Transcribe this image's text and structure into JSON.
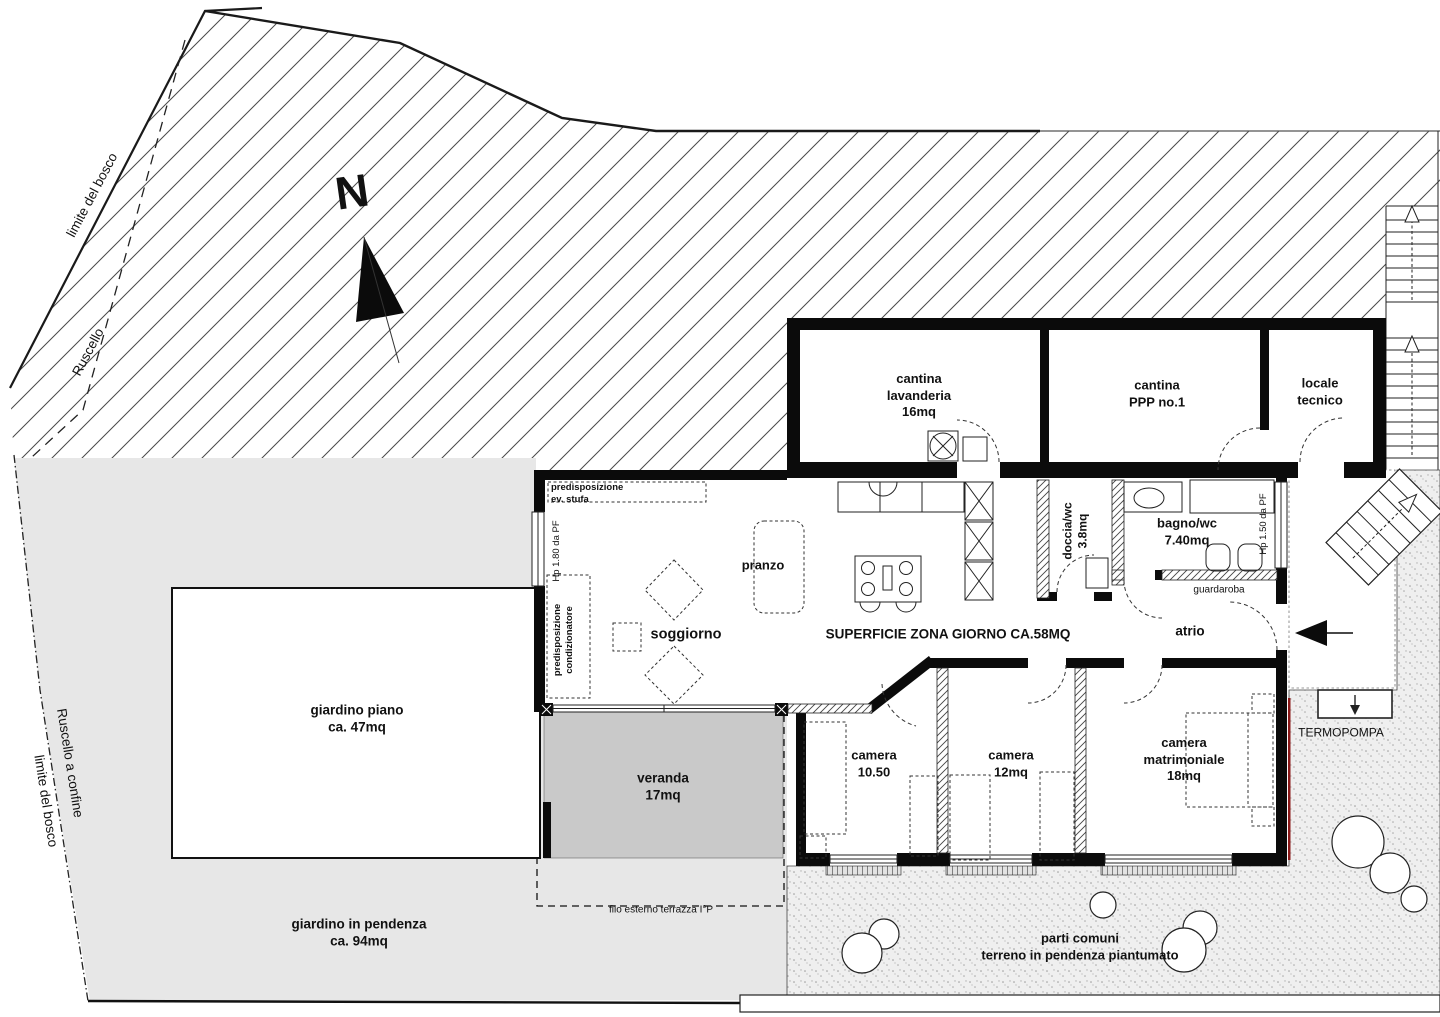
{
  "site": {
    "north": "N",
    "limite_bosco_top": "limite del bosco",
    "ruscello_top": "Ruscello",
    "ruscello_confine": "Ruscello a confine",
    "limite_bosco_left": "limite del bosco"
  },
  "garden": {
    "giardino_piano_1": "giardino piano",
    "giardino_piano_2": "ca. 47mq",
    "giardino_pendenza_1": "giardino in pendenza",
    "giardino_pendenza_2": "ca. 94mq",
    "veranda_1": "veranda",
    "veranda_2": "17mq",
    "parti_comuni_1": "parti comuni",
    "parti_comuni_2": "terreno in pendenza piantumato",
    "filo_esterno": "filo esterno terrazza I°P",
    "termopompa": "TERMOPOMPA"
  },
  "rooms": {
    "cantina_lavanderia_1": "cantina",
    "cantina_lavanderia_2": "lavanderia",
    "cantina_lavanderia_3": "16mq",
    "cantina_ppp_1": "cantina",
    "cantina_ppp_2": "PPP no.1",
    "locale_tecnico_1": "locale",
    "locale_tecnico_2": "tecnico",
    "pranzo": "pranzo",
    "soggiorno": "soggiorno",
    "superficie": "SUPERFICIE ZONA GIORNO CA.58MQ",
    "doccia_1": "doccia/wc",
    "doccia_2": "3.8mq",
    "bagno_1": "bagno/wc",
    "bagno_2": "7.40mq",
    "guardaroba": "guardaroba",
    "atrio": "atrio",
    "camera1_1": "camera",
    "camera1_2": "10.50",
    "camera2_1": "camera",
    "camera2_2": "12mq",
    "camera3_1": "camera",
    "camera3_2": "matrimoniale",
    "camera3_3": "18mq"
  },
  "annotations": {
    "predisp_stufa_1": "predisposizione",
    "predisp_stufa_2": "ev. stufa",
    "predisp_cond_1": "predisposizione",
    "predisp_cond_2": "condizionatore",
    "hp180": "Hp 1.80 da PF",
    "hp150": "Hp 1.50 da PF"
  },
  "colors": {
    "garden_gray": "#e7e7e7",
    "veranda_gray": "#c9c9c9",
    "stipple_bg": "#efefef",
    "wall_black": "#0b0b0b",
    "accent_red": "#8b1a1a"
  }
}
